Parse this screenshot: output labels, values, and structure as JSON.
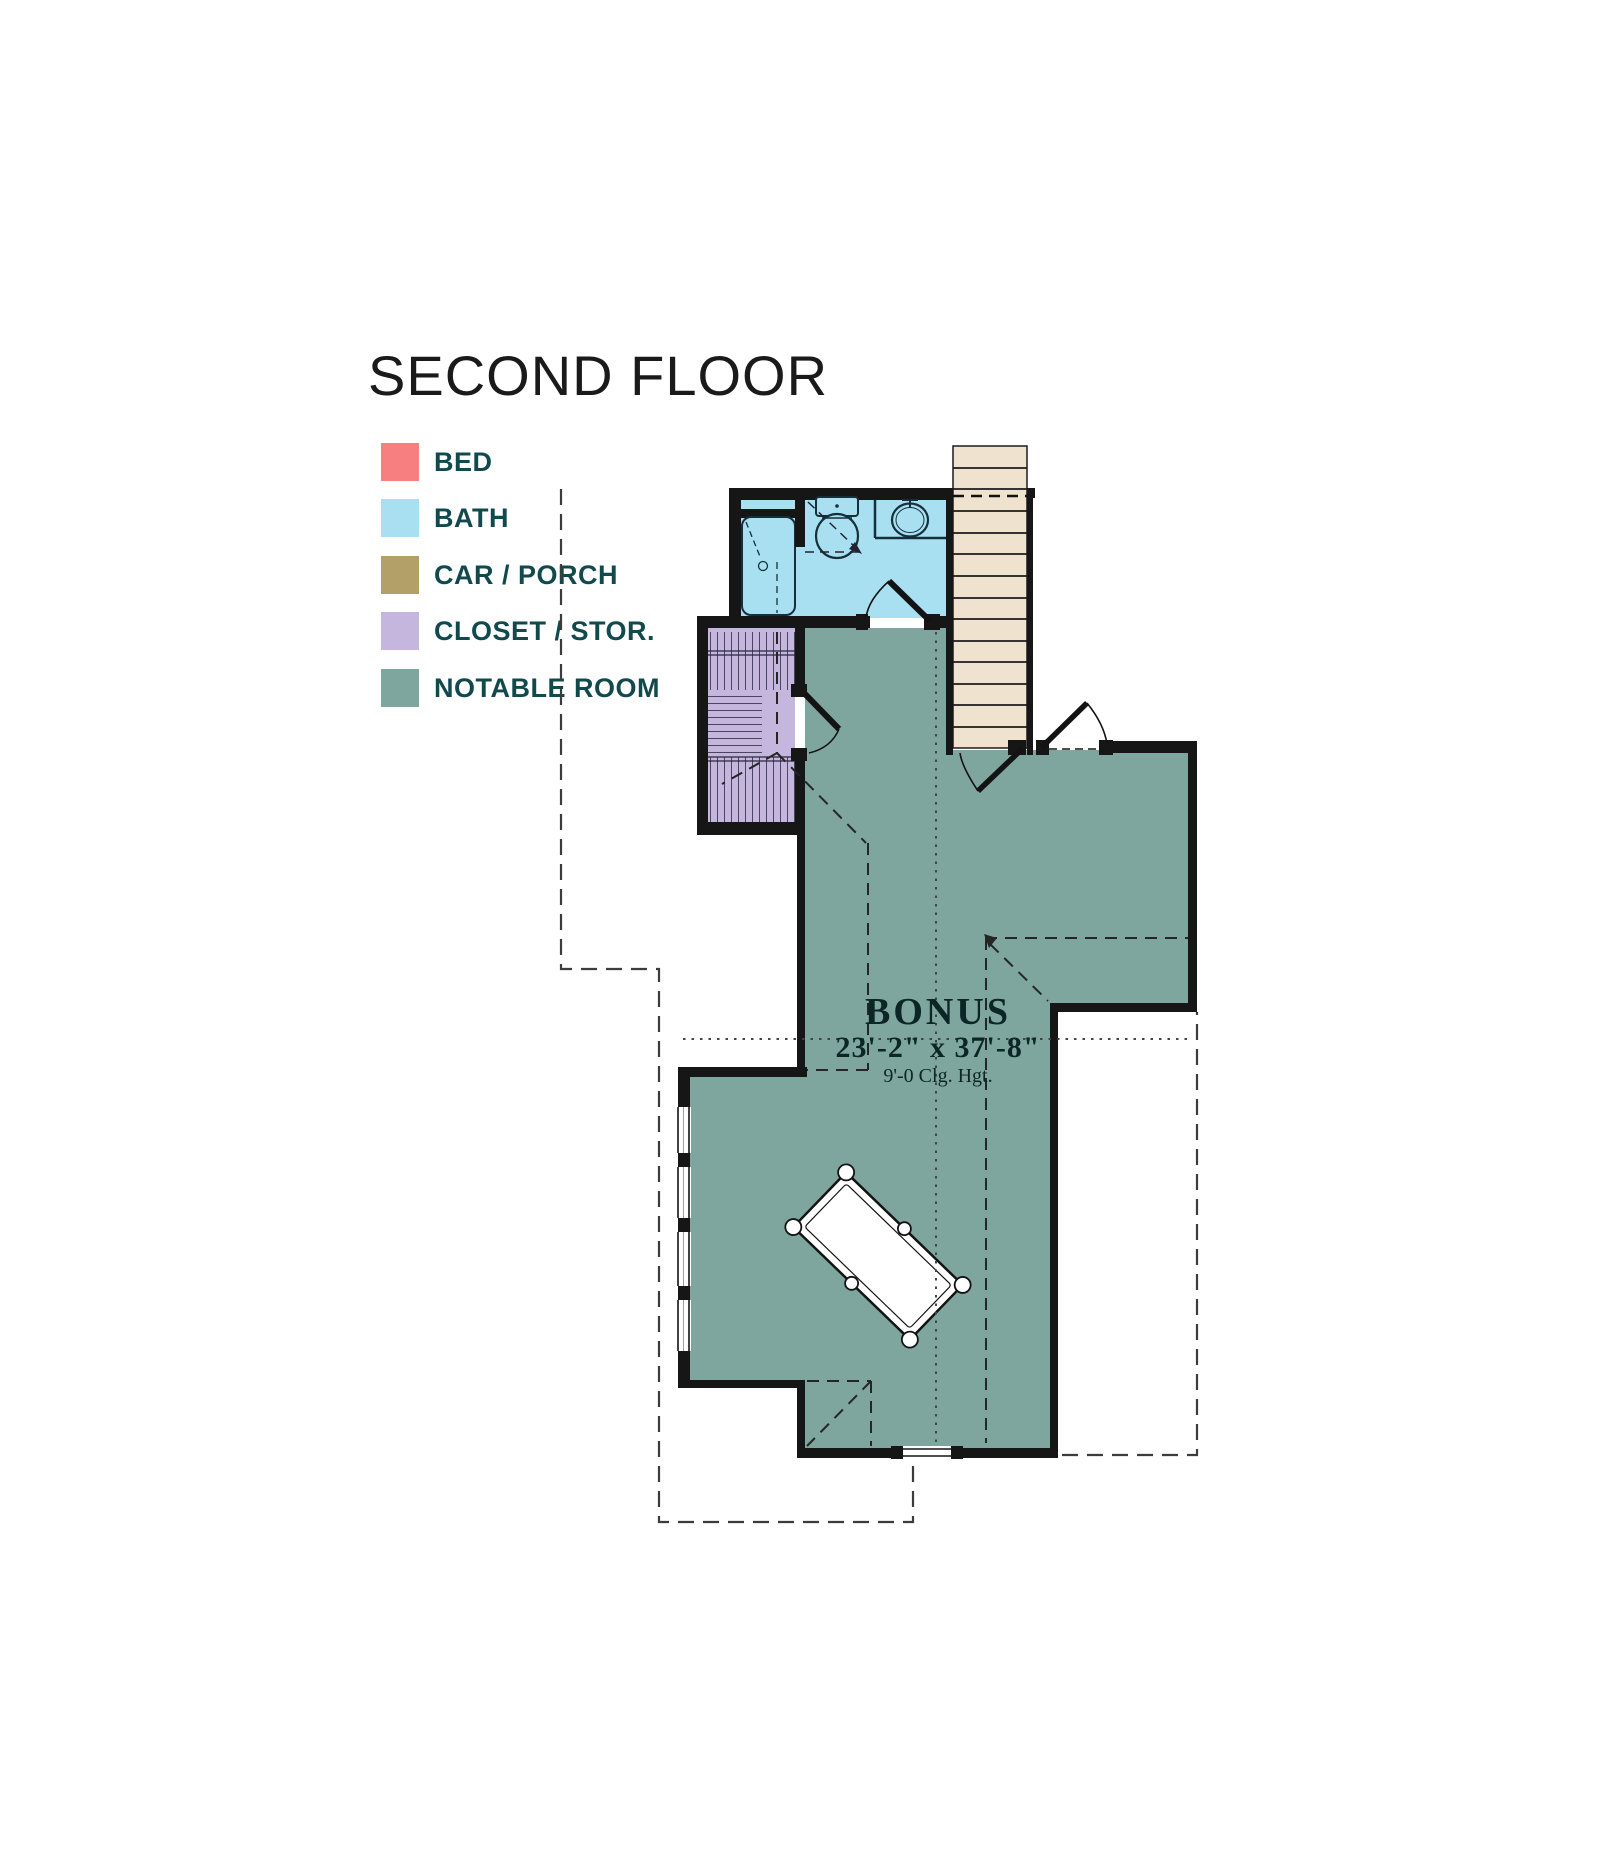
{
  "title": "SECOND FLOOR",
  "legend": {
    "items": [
      {
        "label": "BED",
        "color": "#f87f80"
      },
      {
        "label": "BATH",
        "color": "#a8e0f2"
      },
      {
        "label": "CAR / PORCH",
        "color": "#b3a069"
      },
      {
        "label": "CLOSET / STOR.",
        "color": "#c5b6dd"
      },
      {
        "label": "NOTABLE ROOM",
        "color": "#7ea69e"
      }
    ]
  },
  "bonus_room": {
    "name": "BONUS",
    "dimensions": "23'-2\" x 37'-8\"",
    "ceiling_height": "9'-0 Clg. Hgt."
  },
  "plan": {
    "colors": {
      "walls": "#161616",
      "bath_fill": "#a8e0f2",
      "closet_fill": "#c5b6dd",
      "notable_fill": "#7ea69e",
      "stair_fill": "#efe3d0",
      "dashed_lines": "#3c3c3c",
      "legend_text": "#12494d"
    },
    "features": [
      "shower-tub-icon",
      "toilet-icon",
      "sink-icon",
      "stairs-icon",
      "pool-table-icon",
      "door-swing-icon",
      "window-icon",
      "closet-hatch-icon",
      "roof-dashed-line",
      "footprint-dashed-outline"
    ]
  }
}
